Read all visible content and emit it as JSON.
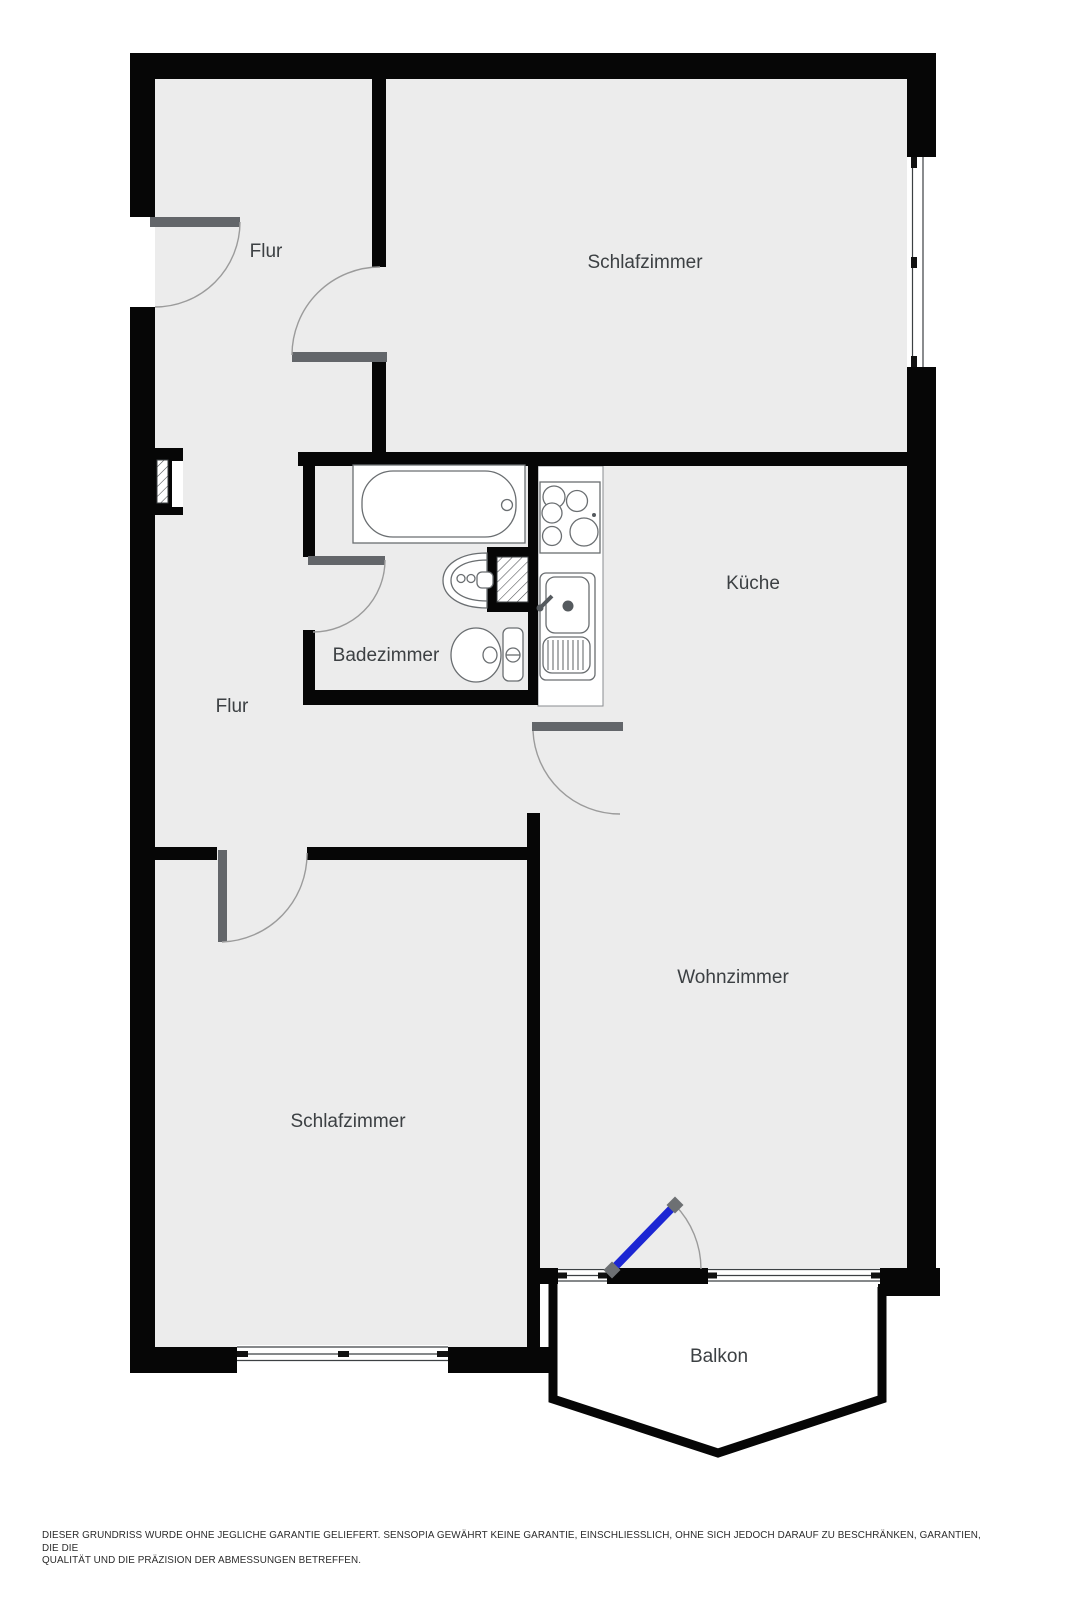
{
  "rooms": [
    {
      "id": "flur-top",
      "label": "Flur"
    },
    {
      "id": "schlafzimmer-top",
      "label": "Schlafzimmer"
    },
    {
      "id": "kueche",
      "label": "Küche"
    },
    {
      "id": "badezimmer",
      "label": "Badezimmer"
    },
    {
      "id": "flur-mid",
      "label": "Flur"
    },
    {
      "id": "wohnzimmer",
      "label": "Wohnzimmer"
    },
    {
      "id": "schlafzimmer-bottom",
      "label": "Schlafzimmer"
    },
    {
      "id": "balkon",
      "label": "Balkon"
    }
  ],
  "fixtures": [
    "bathtub-icon",
    "washbasin-icon",
    "toilet-icon",
    "stove-icon",
    "kitchen-sink-icon",
    "shaft-hatch-icon",
    "entry-door-swing",
    "interior-door-swing",
    "balcony-door-swing",
    "window-glyph"
  ],
  "disclaimer": {
    "line1": "DIESER GRUNDRISS WURDE OHNE JEGLICHE GARANTIE GELIEFERT. SENSOPIA GEWÄHRT KEINE GARANTIE, EINSCHLIESSLICH, OHNE SICH JEDOCH DARAUF ZU BESCHRÄNKEN, GARANTIEN, DIE DIE",
    "line2": "QUALITÄT UND DIE PRÄZISION DER ABMESSUNGEN BETREFFEN."
  },
  "colors": {
    "wall": "#060606",
    "interior": "#ececec",
    "door_leaf": "#63666a",
    "balcony_door": "#1c26d3",
    "label_text": "#3c4043"
  }
}
